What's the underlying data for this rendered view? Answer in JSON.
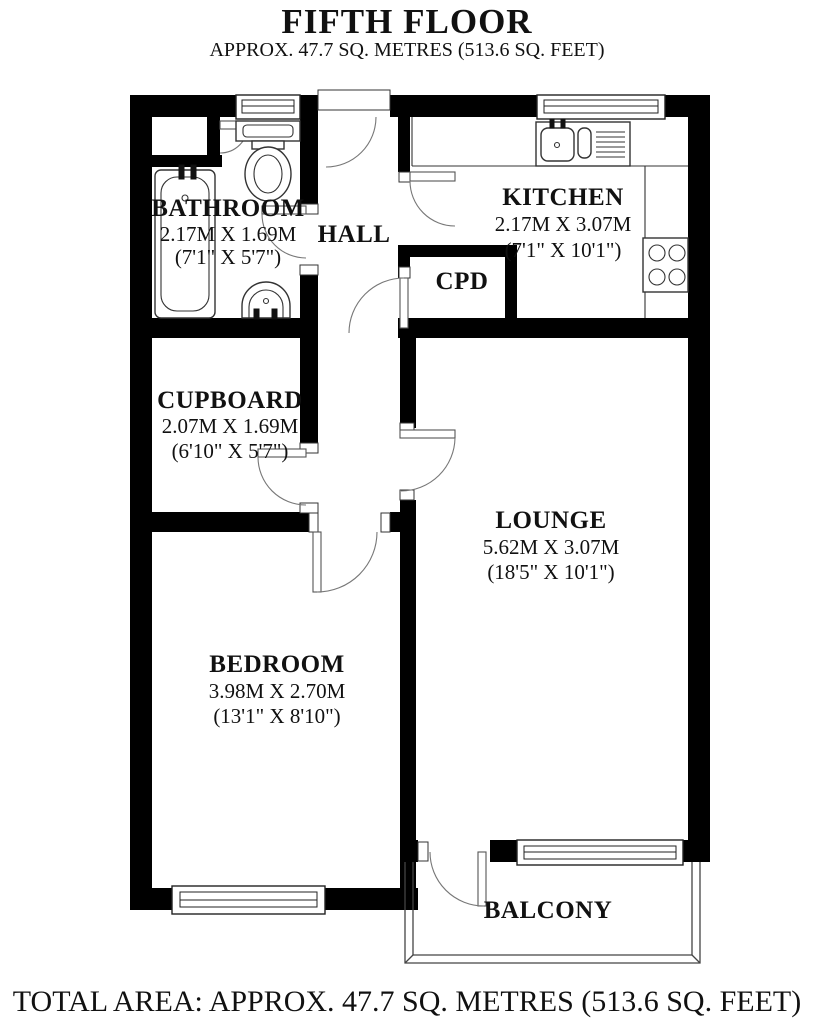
{
  "header": {
    "title": "FIFTH FLOOR",
    "subtitle": "APPROX. 47.7 SQ. METRES (513.6 SQ. FEET)"
  },
  "footer": {
    "text": "TOTAL AREA: APPROX. 47.7 SQ. METRES (513.6 SQ. FEET)"
  },
  "rooms": {
    "bathroom": {
      "name": "BATHROOM",
      "dims_metric": "2.17M X 1.69M",
      "dims_imperial": "(7'1\" X 5'7\")"
    },
    "hall": {
      "name": "HALL"
    },
    "kitchen": {
      "name": "KITCHEN",
      "dims_metric": "2.17M X 3.07M",
      "dims_imperial": "(7'1\" X 10'1\")"
    },
    "cpd": {
      "name": "CPD"
    },
    "cupboard": {
      "name": "CUPBOARD",
      "dims_metric": "2.07M X 1.69M",
      "dims_imperial": "(6'10\" X 5'7\")"
    },
    "lounge": {
      "name": "LOUNGE",
      "dims_metric": "5.62M X 3.07M",
      "dims_imperial": "(18'5\" X 10'1\")"
    },
    "bedroom": {
      "name": "BEDROOM",
      "dims_metric": "3.98M X 2.70M",
      "dims_imperial": "(13'1\" X 8'10\")"
    },
    "balcony": {
      "name": "BALCONY"
    }
  },
  "fixtures": {
    "bathroom": [
      "bathtub",
      "toilet",
      "washbasin"
    ],
    "kitchen": [
      "sink-drainer",
      "hob"
    ]
  },
  "colors": {
    "wall": "#000000",
    "background": "#ffffff",
    "line": "#333333"
  }
}
